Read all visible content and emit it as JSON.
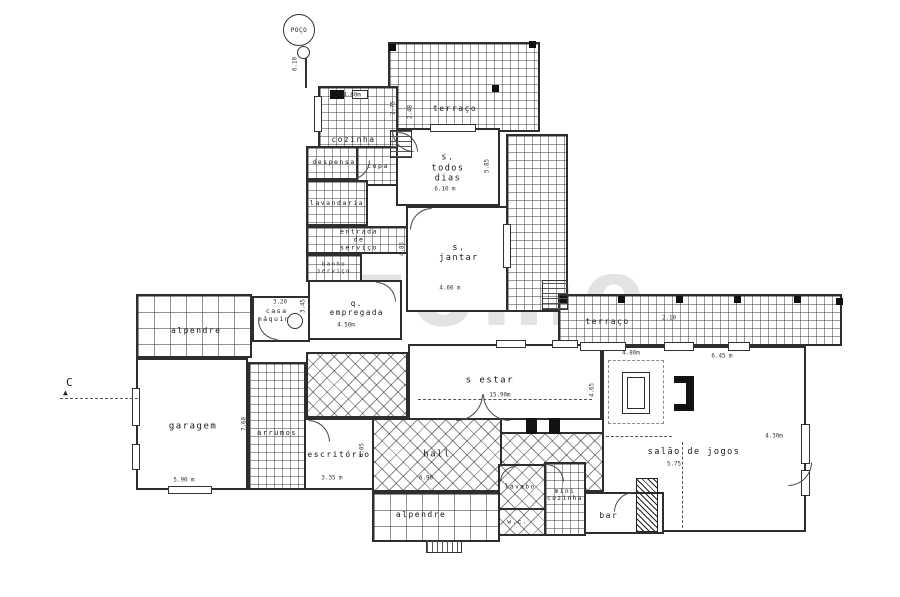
{
  "watermark": {
    "text": "zome"
  },
  "plan": {
    "rooms": [
      {
        "id": "terraco-top",
        "label": "terraço",
        "x": 388,
        "y": 42,
        "w": 152,
        "h": 90,
        "p": "grid-sm",
        "lp": [
          44,
          76
        ],
        "fs": 8
      },
      {
        "id": "terraco-east",
        "label": "",
        "x": 506,
        "y": 134,
        "w": 62,
        "h": 178,
        "p": "grid-sm"
      },
      {
        "id": "terraco-right",
        "label": "terraço",
        "x": 558,
        "y": 294,
        "w": 284,
        "h": 52,
        "p": "grid-sm",
        "lp": [
          17,
          55
        ],
        "fs": 8
      },
      {
        "id": "alpendre-left",
        "label": "alpendre",
        "x": 136,
        "y": 294,
        "w": 116,
        "h": 64,
        "p": "grid-lg",
        "lp": [
          52,
          58
        ],
        "fs": 8
      },
      {
        "id": "patio-mid",
        "label": "",
        "x": 306,
        "y": 352,
        "w": 102,
        "h": 66,
        "p": "diamond"
      },
      {
        "id": "hall",
        "label": "hall",
        "x": 372,
        "y": 418,
        "w": 130,
        "h": 74,
        "p": "diamond",
        "lp": [
          50,
          50
        ],
        "fs": 9
      },
      {
        "id": "vestibule",
        "label": "",
        "x": 500,
        "y": 432,
        "w": 104,
        "h": 60,
        "p": "diamond"
      },
      {
        "id": "alpendre-bottom",
        "label": "alpendre",
        "x": 372,
        "y": 492,
        "w": 128,
        "h": 50,
        "p": "grid-lg",
        "lp": [
          38,
          46
        ],
        "fs": 8
      },
      {
        "id": "arrumos",
        "label": "arrumos",
        "x": 248,
        "y": 362,
        "w": 58,
        "h": 128,
        "p": "grid-sm",
        "lp": [
          50,
          56
        ],
        "fs": 7
      },
      {
        "id": "cozinha",
        "label": "cozinha",
        "x": 318,
        "y": 86,
        "w": 80,
        "h": 96,
        "p": "grid-sm",
        "lp": [
          44,
          57
        ],
        "fs": 8
      },
      {
        "id": "despensa",
        "label": "despensa",
        "x": 306,
        "y": 146,
        "w": 56,
        "h": 34,
        "p": "grid-sm",
        "lp": [
          50,
          50
        ],
        "fs": 6.5
      },
      {
        "id": "copa",
        "label": "copa",
        "x": 356,
        "y": 146,
        "w": 44,
        "h": 40,
        "p": "grid-sm",
        "lp": [
          50,
          52
        ],
        "fs": 6.5
      },
      {
        "id": "lavandaria",
        "label": "lavandaria",
        "x": 306,
        "y": 180,
        "w": 62,
        "h": 46,
        "p": "grid-sm",
        "lp": [
          50,
          52
        ],
        "fs": 6.5
      },
      {
        "id": "entrada-servico",
        "label": "entrada de serviço",
        "x": 306,
        "y": 226,
        "w": 106,
        "h": 28,
        "p": "grid-sm",
        "lp": [
          50,
          50
        ],
        "fs": 6.5
      },
      {
        "id": "banho-servico",
        "label": "banho\nserviço",
        "x": 306,
        "y": 254,
        "w": 56,
        "h": 28,
        "p": "grid-sm",
        "lp": [
          50,
          50
        ],
        "fs": 5.5
      },
      {
        "id": "s-todos-dias",
        "label": "s. todos dias",
        "x": 396,
        "y": 128,
        "w": 104,
        "h": 78,
        "p": "",
        "lp": [
          50,
          52
        ],
        "fs": 8.5
      },
      {
        "id": "s-jantar",
        "label": "s. jantar",
        "x": 406,
        "y": 206,
        "w": 102,
        "h": 106,
        "p": "",
        "lp": [
          52,
          44
        ],
        "fs": 8.5
      },
      {
        "id": "q-empregada",
        "label": "q. empregada",
        "x": 308,
        "y": 280,
        "w": 94,
        "h": 60,
        "p": "",
        "lp": [
          52,
          46
        ],
        "fs": 7.5
      },
      {
        "id": "casa-maquina",
        "label": "casa\nmáquina",
        "x": 252,
        "y": 296,
        "w": 58,
        "h": 46,
        "p": "",
        "lp": [
          42,
          44
        ],
        "fs": 6.5
      },
      {
        "id": "garagem",
        "label": "garagem",
        "x": 136,
        "y": 358,
        "w": 112,
        "h": 132,
        "p": "",
        "lp": [
          51,
          52
        ],
        "fs": 9
      },
      {
        "id": "escritorio",
        "label": "escritório",
        "x": 304,
        "y": 418,
        "w": 70,
        "h": 72,
        "p": "",
        "lp": [
          50,
          52
        ],
        "fs": 8
      },
      {
        "id": "s-estar",
        "label": "s estar",
        "x": 408,
        "y": 344,
        "w": 194,
        "h": 76,
        "p": "",
        "lp": [
          42,
          48
        ],
        "fs": 9
      },
      {
        "id": "salao-jogos",
        "label": "salão de jogos",
        "x": 602,
        "y": 346,
        "w": 204,
        "h": 186,
        "p": "",
        "lp": [
          45,
          57
        ],
        "fs": 8.5
      },
      {
        "id": "lavabo",
        "label": "lavabo",
        "x": 498,
        "y": 464,
        "w": 48,
        "h": 46,
        "p": "diamond",
        "lp": [
          46,
          50
        ],
        "fs": 6
      },
      {
        "id": "wc",
        "label": "w.c.",
        "x": 498,
        "y": 508,
        "w": 48,
        "h": 28,
        "p": "diamond",
        "lp": [
          40,
          50
        ],
        "fs": 6
      },
      {
        "id": "mini-cozinha",
        "label": "mini\ncozinha",
        "x": 544,
        "y": 462,
        "w": 42,
        "h": 74,
        "p": "grid-sm",
        "lp": [
          50,
          44
        ],
        "fs": 6
      },
      {
        "id": "bar",
        "label": "bar",
        "x": 584,
        "y": 492,
        "w": 80,
        "h": 42,
        "p": "",
        "lp": [
          30,
          58
        ],
        "fs": 8
      }
    ],
    "dims": [
      {
        "t": "4.80m",
        "x": 352,
        "y": 95,
        "r": 0
      },
      {
        "t": "2.75",
        "x": 393,
        "y": 108,
        "r": -90
      },
      {
        "t": "2.48",
        "x": 410,
        "y": 112,
        "r": -90
      },
      {
        "t": "6.10 m",
        "x": 445,
        "y": 189,
        "r": 0
      },
      {
        "t": "5.85",
        "x": 487,
        "y": 166,
        "r": -90
      },
      {
        "t": "4.85",
        "x": 402,
        "y": 249,
        "r": -90
      },
      {
        "t": "4.66 m",
        "x": 450,
        "y": 288,
        "r": 0
      },
      {
        "t": "3.45",
        "x": 303,
        "y": 306,
        "r": -90
      },
      {
        "t": "4.50m",
        "x": 346,
        "y": 325,
        "r": 0
      },
      {
        "t": "3.20",
        "x": 280,
        "y": 302,
        "r": 0
      },
      {
        "t": "7.60",
        "x": 244,
        "y": 424,
        "r": -90
      },
      {
        "t": "5.90 m",
        "x": 184,
        "y": 480,
        "r": 0
      },
      {
        "t": "3.35 m",
        "x": 332,
        "y": 478,
        "r": 0
      },
      {
        "t": "4.05",
        "x": 362,
        "y": 450,
        "r": -90
      },
      {
        "t": "6.90",
        "x": 426,
        "y": 478,
        "r": 0
      },
      {
        "t": "15.90m",
        "x": 500,
        "y": 395,
        "r": 0
      },
      {
        "t": "4.65",
        "x": 592,
        "y": 390,
        "r": -90
      },
      {
        "t": "2.10",
        "x": 669,
        "y": 318,
        "r": 0
      },
      {
        "t": "4.80m",
        "x": 631,
        "y": 353,
        "r": 0
      },
      {
        "t": "6.45 m",
        "x": 722,
        "y": 356,
        "r": 0
      },
      {
        "t": "5.75",
        "x": 674,
        "y": 464,
        "r": 0
      },
      {
        "t": "4.30m",
        "x": 774,
        "y": 436,
        "r": 0
      },
      {
        "t": "6.10",
        "x": 295,
        "y": 64,
        "r": -90
      }
    ],
    "pillars": [
      [
        389,
        44
      ],
      [
        529,
        41
      ],
      [
        492,
        85
      ],
      [
        560,
        296
      ],
      [
        618,
        296
      ],
      [
        676,
        296
      ],
      [
        734,
        296
      ],
      [
        794,
        296
      ],
      [
        836,
        298
      ]
    ],
    "windows": [
      [
        430,
        124,
        46,
        8
      ],
      [
        314,
        96,
        8,
        36
      ],
      [
        132,
        388,
        8,
        38
      ],
      [
        132,
        444,
        8,
        26
      ],
      [
        503,
        224,
        8,
        44
      ],
      [
        168,
        486,
        44,
        8
      ],
      [
        580,
        342,
        46,
        9
      ],
      [
        664,
        342,
        30,
        9
      ],
      [
        728,
        342,
        22,
        9
      ],
      [
        801,
        424,
        9,
        40
      ],
      [
        801,
        470,
        9,
        26
      ],
      [
        496,
        340,
        30,
        8
      ],
      [
        552,
        340,
        26,
        8
      ]
    ],
    "arcs": [
      {
        "x": 392,
        "y": 130,
        "r": 22,
        "rot": 270
      },
      {
        "x": 398,
        "y": 132,
        "r": 20,
        "rot": 90
      },
      {
        "x": 350,
        "y": 160,
        "r": 20,
        "rot": 180
      },
      {
        "x": 410,
        "y": 208,
        "r": 22,
        "rot": 0
      },
      {
        "x": 376,
        "y": 282,
        "r": 20,
        "rot": 90
      },
      {
        "x": 258,
        "y": 320,
        "r": 20,
        "rot": 270
      },
      {
        "x": 308,
        "y": 420,
        "r": 22,
        "rot": 90
      },
      {
        "x": 456,
        "y": 394,
        "r": 27,
        "rot": 180
      },
      {
        "x": 483,
        "y": 394,
        "r": 27,
        "rot": 270
      },
      {
        "x": 788,
        "y": 462,
        "r": 24,
        "rot": 180
      },
      {
        "x": 546,
        "y": 464,
        "r": 18,
        "rot": 90
      },
      {
        "x": 500,
        "y": 466,
        "r": 16,
        "rot": 0
      },
      {
        "x": 614,
        "y": 492,
        "r": 20,
        "rot": 0
      }
    ],
    "lines": [
      {
        "x": 60,
        "y": 398,
        "len": 78,
        "o": "h"
      },
      {
        "x": 418,
        "y": 399,
        "len": 174,
        "o": "h"
      },
      {
        "x": 606,
        "y": 436,
        "len": 66,
        "o": "h"
      },
      {
        "x": 682,
        "y": 442,
        "len": 86,
        "o": "v"
      },
      {
        "x": 305,
        "y": 58,
        "len": 30,
        "o": "sv"
      }
    ],
    "fills": [
      [
        674,
        376,
        14,
        7
      ],
      [
        674,
        404,
        14,
        7
      ],
      [
        686,
        376,
        8,
        35
      ],
      [
        526,
        418,
        11,
        16
      ],
      [
        549,
        418,
        11,
        16
      ],
      [
        330,
        90,
        14,
        9
      ]
    ],
    "rects": [
      [
        622,
        372,
        28,
        42
      ],
      [
        627,
        377,
        18,
        32
      ],
      [
        352,
        90,
        16,
        9
      ]
    ],
    "dashrects": [
      [
        608,
        360,
        56,
        64
      ]
    ],
    "hatches": [
      [
        636,
        478,
        22,
        54
      ]
    ],
    "steps": [
      {
        "x": 390,
        "y": 130,
        "w": 22,
        "h": 28,
        "o": "h"
      },
      {
        "x": 542,
        "y": 280,
        "w": 26,
        "h": 30,
        "o": "h"
      },
      {
        "x": 426,
        "y": 540,
        "w": 36,
        "h": 13,
        "o": "v"
      }
    ],
    "circles": [
      {
        "x": 283,
        "y": 14,
        "d": 32,
        "label": "POÇO",
        "fs": 6
      },
      {
        "x": 297,
        "y": 46,
        "d": 13
      },
      {
        "x": 287,
        "y": 313,
        "d": 16
      }
    ],
    "texts": [
      {
        "t": "C",
        "x": 66,
        "y": 376,
        "fs": 11
      },
      {
        "t": "▲",
        "x": 63,
        "y": 388,
        "fs": 8
      }
    ]
  }
}
